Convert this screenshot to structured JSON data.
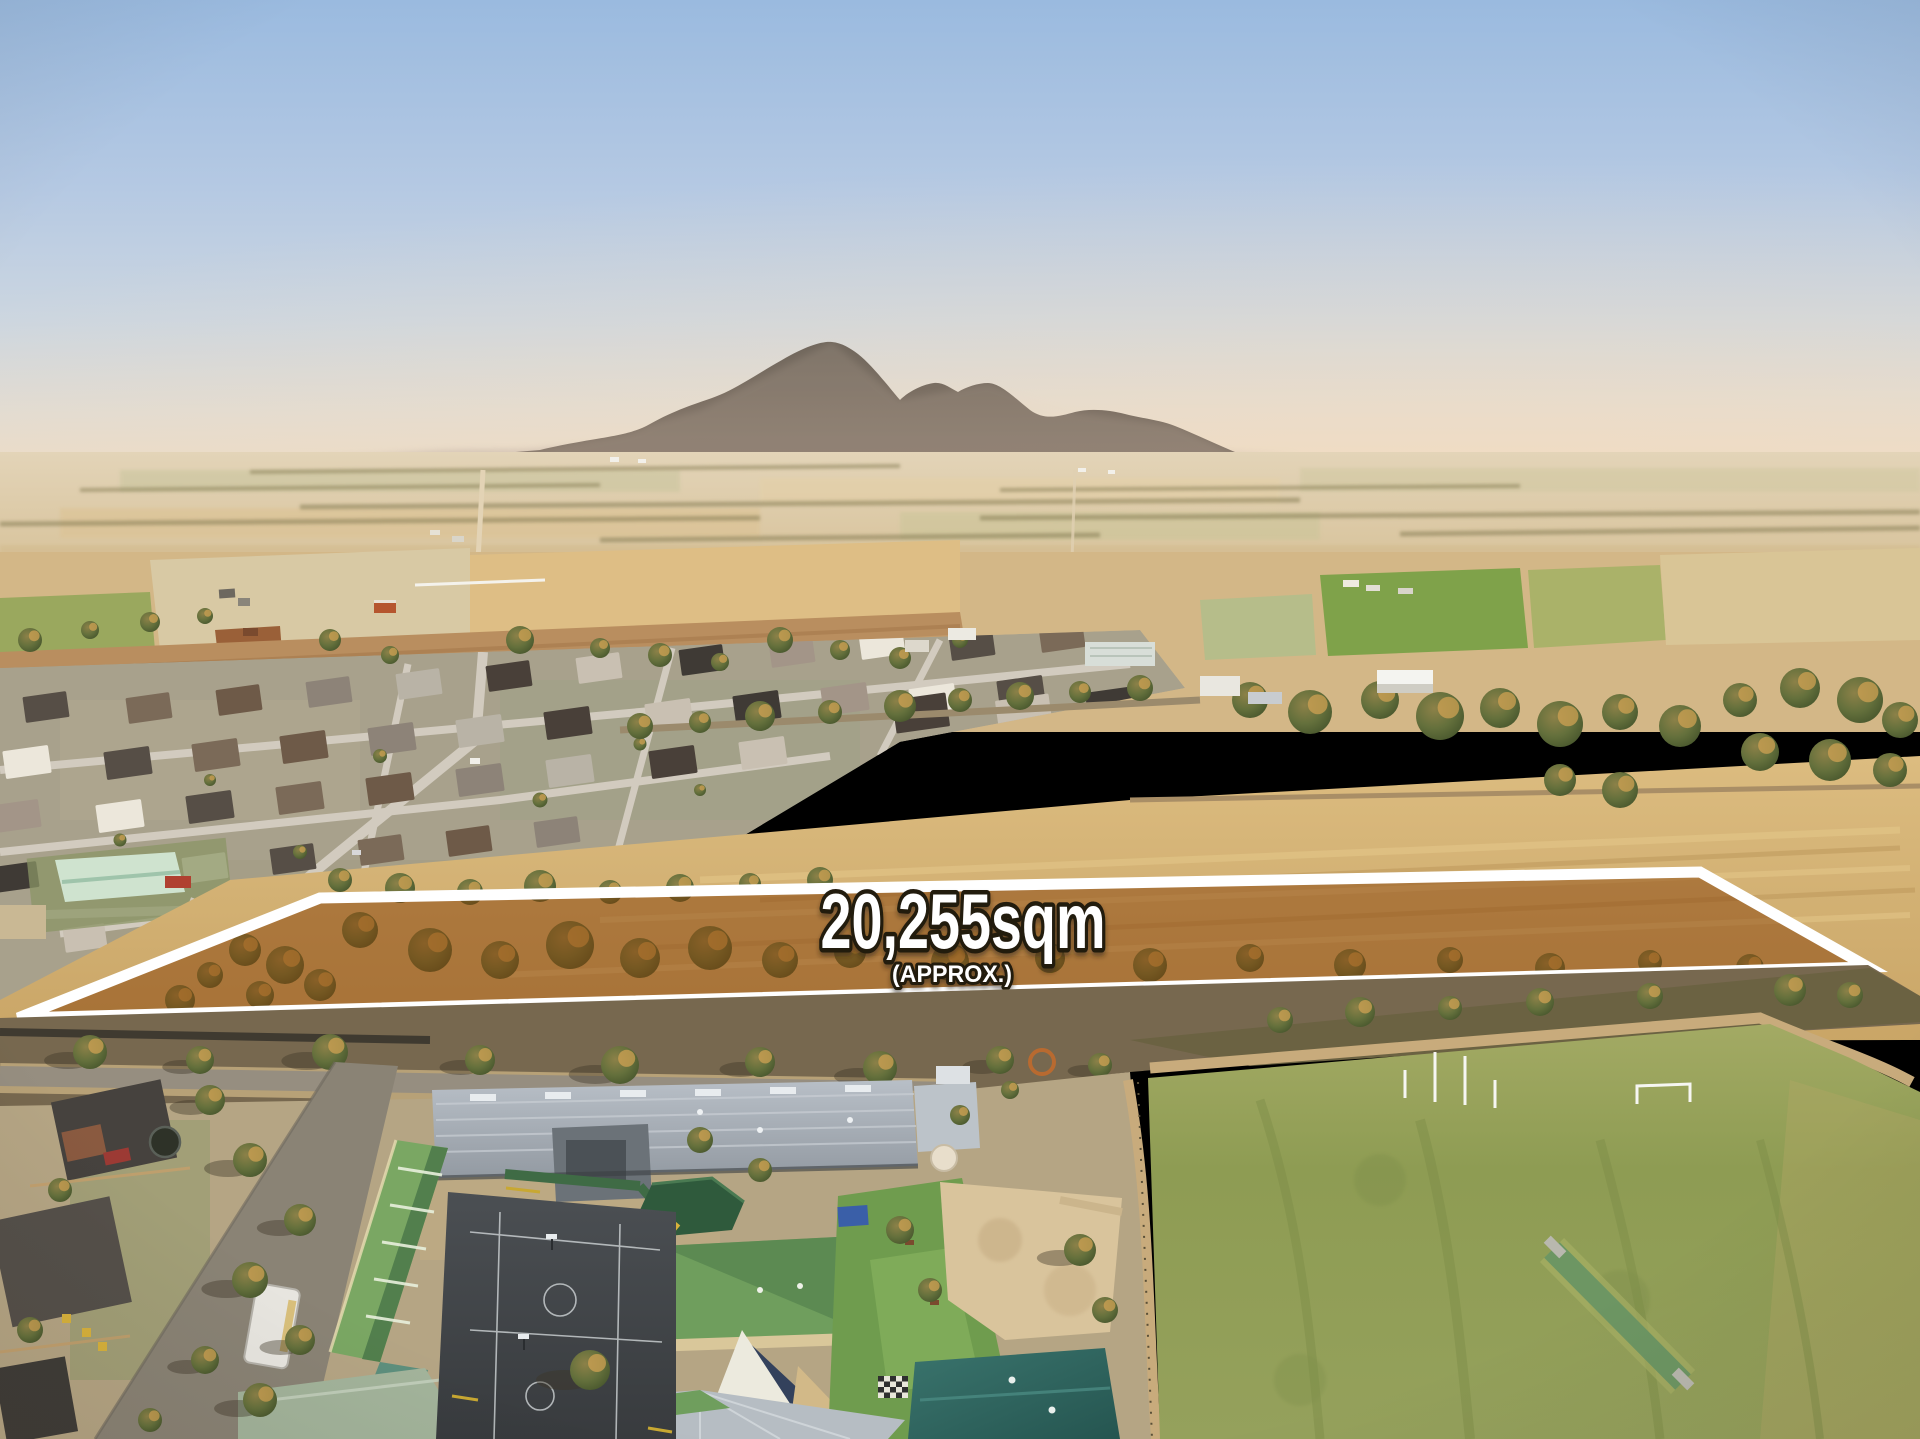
{
  "overlay": {
    "area_label": "20,255sqm",
    "area_qualifier": "(APPROX.)",
    "label_color": "#ffffff",
    "label_outline_color": "#241a10",
    "parcel_fill_color": "rgba(133,64,8,0.5)",
    "parcel_border_color": "#ffffff"
  },
  "scene": {
    "description": "Golden-hour aerial drone view over a country town: hazy blue sky, distant mountain range, patchwork farm paddocks, new housing estate at left, tree belts, a school campus with green metal roofs and asphalt courts at bottom centre, and a large grass sports oval with goal posts and a cricket pitch at bottom right. A long narrow vacant paddock across the middle ground is outlined in white, shaded brown and labelled with its land area.",
    "palette": {
      "sky_top": "#9abadf",
      "sky_horizon": "#ecdcc6",
      "mountains": "#6b6156",
      "haze": "#e3d3c2",
      "dry_paddock": "#d9b97f",
      "green_paddock": "#7fa24a",
      "tree_canopy": "#5d6c39",
      "tree_highlight": "#cfa253",
      "estate_street": "#d2cbbf",
      "school_roof_green": "#6f9e5d",
      "school_roof_teal": "#35706a",
      "school_roof_gray": "#b3bac2",
      "oval_grass": "#97a35d",
      "cricket_pitch": "#6d9663",
      "asphalt_court": "#44484c",
      "road": "#968e80",
      "sand": "#d9c49c",
      "dirt_strip": "#b98e5f"
    }
  }
}
